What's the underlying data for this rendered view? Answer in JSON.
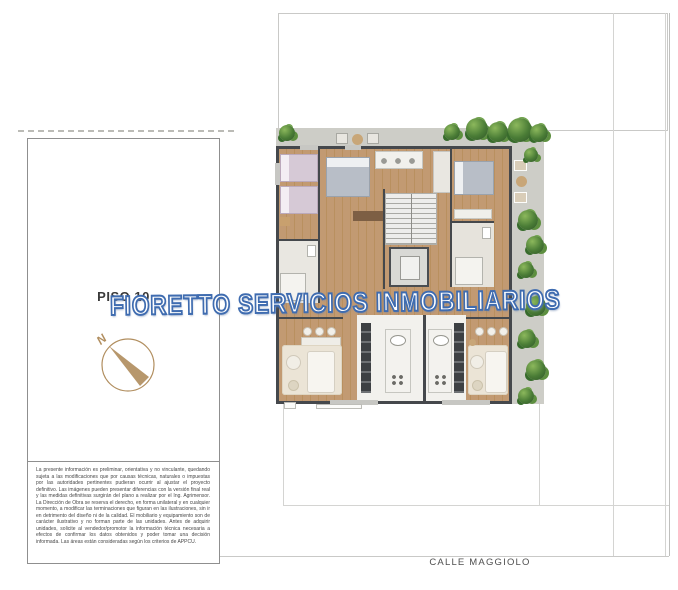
{
  "watermark": {
    "text": "FIORETTO SERVICIOS INMOBILIARIOS",
    "outline_color": "#3f6cb0",
    "fill_color": "#ffffff"
  },
  "left_panel": {
    "title": "PISO 10",
    "compass_label": "N",
    "compass_color": "#b18e5f",
    "disclaimer": "La presente información es preliminar, orientativa y no vinculante, quedando sujeta a las modificaciones que por causas técnicas, naturales o impuestas por las autoridades pertinentes pudieran ocurrir al ajustar el proyecto definitivo. Las imágenes pueden presentar diferencias con la versión final real y las medidas definitivas surgirán del plano a realizar por el Ing. Agrimensor. La Dirección de Obra se reserva el derecho, en forma unilateral y en cualquier momento, a modificar las terminaciones que figuran en las ilustraciones, sin ir en detrimento del diseño ni de la calidad. El mobiliario y equipamiento son de carácter ilustrativo y no forman parte de las unidades. Antes de adquirir unidades, solicite al vendedor/promotor la información técnica necesaria a efectos de confirmar los datos obtenidos y poder tomar una decisión informada. Las áreas están consideradas según los criterios de APPCU."
  },
  "street_label": "CALLE MAGGIOLO",
  "plan_colors": {
    "wall": "#45484c",
    "wood_floor": "#c29a72",
    "concrete": "#cdcdc7",
    "bathroom": "#e9e7e1",
    "plants": "#4a7c36"
  }
}
